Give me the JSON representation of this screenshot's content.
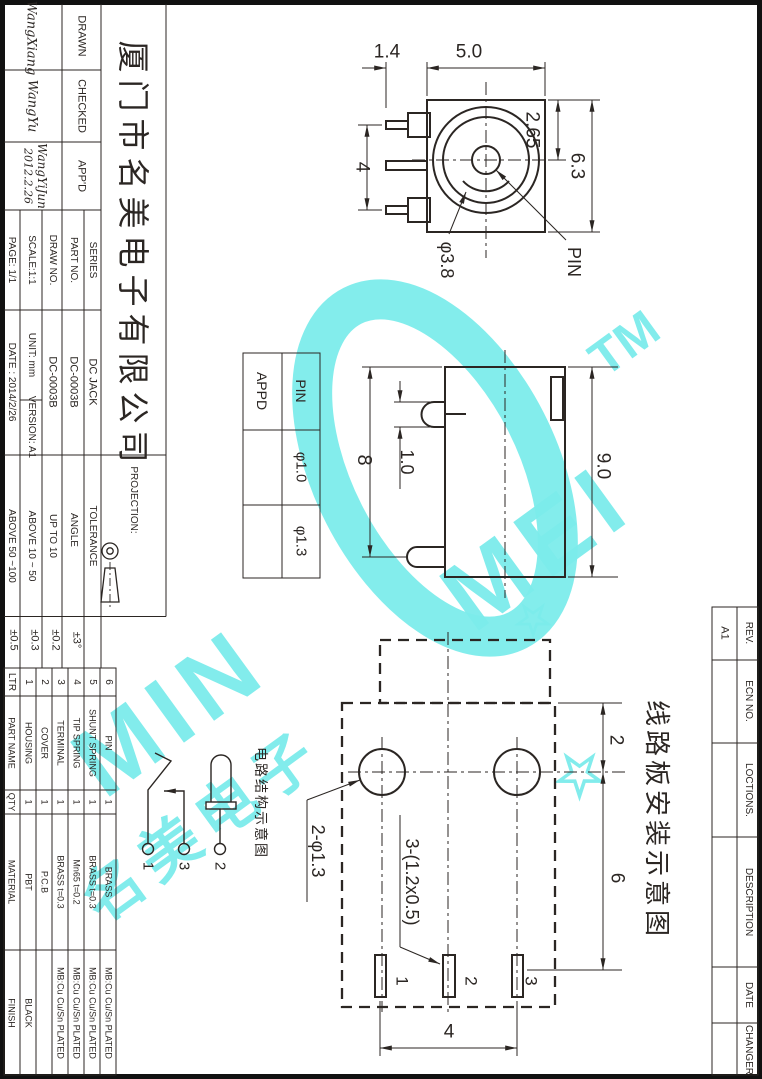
{
  "sheet": {
    "company": "厦门市名美电子有限公司",
    "signatures": {
      "drawn_label": "DRAWN",
      "checked_label": "CHECKED",
      "approved_label": "APP'D",
      "drawn": "WangXiang",
      "checked": "WangYu",
      "approved": "WangYiJun",
      "approved_date": "2012.2.26"
    },
    "fields": {
      "series_label": "SERIES",
      "series": "DC JACK",
      "part_no_label": "PART NO.",
      "part_no": "DC-0003B",
      "draw_no_label": "DRAW NO.",
      "draw_no": "DC-0003B",
      "scale": "SCALE:1:1",
      "unit": "UNIT: mm",
      "version": "VERSION: A1",
      "page": "PAGE: 1/1",
      "date": "DATE : 2014/2/26",
      "projection_label": "PROJECTION:"
    },
    "tolerance": {
      "header": "TOLERANCE",
      "rows": [
        {
          "label": "ANGLE",
          "value": "±3°"
        },
        {
          "label": "UP TO 10",
          "value": "±0.2"
        },
        {
          "label": "ABOVE 10 ~ 50",
          "value": "±0.3"
        },
        {
          "label": "ABOVE 50 ~100",
          "value": "±0.5"
        }
      ]
    },
    "bom": {
      "headers": {
        "ltr": "LTR",
        "part_name": "PART NAME",
        "qty": "QTY",
        "material": "MATERIAL",
        "finish": "FINISH"
      },
      "rows": [
        {
          "ltr": "1",
          "name": "HOUSING",
          "qty": "1",
          "material": "PBT",
          "finish": "BLACK"
        },
        {
          "ltr": "2",
          "name": "COVER",
          "qty": "1",
          "material": "P.C.B",
          "finish": ""
        },
        {
          "ltr": "3",
          "name": "TERMINAL",
          "qty": "1",
          "material": "BRASS t=0.3",
          "finish": "MB:Cu Cu/Sn PLATED"
        },
        {
          "ltr": "4",
          "name": "TIP SPRING",
          "qty": "1",
          "material": "Mn65 t=0.2",
          "finish": "MB:Cu Cu/Sn PLATED"
        },
        {
          "ltr": "5",
          "name": "SHUNT SPRING",
          "qty": "1",
          "material": "BRASS t=0.3",
          "finish": "MB:Cu Cu/Sn PLATED"
        },
        {
          "ltr": "6",
          "name": "PIN",
          "qty": "1",
          "material": "BRASS",
          "finish": "MB:Cu Cu/Sn PLATED"
        }
      ]
    },
    "revision": {
      "rev_label": "REV.",
      "rev_value": "A1",
      "ecn_label": "ECN NO.",
      "locations_label": "LOCTIONS.",
      "description_label": "DESCRIPTION",
      "date_label": "DATE",
      "changer_label": "CHANGER"
    }
  },
  "views": {
    "front": {
      "dims": {
        "pin_offset": "1.4",
        "body_width": "5.0",
        "center_from_top": "2.65",
        "body_height": "6.3",
        "pin_pitch": "4",
        "barrel_dia": "φ3.8",
        "pin_callout": "PIN"
      }
    },
    "side": {
      "table": {
        "appd": "APPD",
        "pin": "PIN",
        "dia_small": "φ1.0",
        "dia_large": "φ1.3"
      },
      "dims": {
        "body_height": "8",
        "pin_thickness": "1.0",
        "overall": "9.0"
      }
    },
    "pcb": {
      "title": "线路板安装示意图",
      "dims": {
        "hole_from_edge": "2",
        "hole_to_pad": "6",
        "pad_pitch": "4",
        "holes": "2-φ1.3",
        "slots": "3-(1.2x0.5)"
      },
      "pads": [
        "1",
        "2",
        "3"
      ]
    },
    "schematic": {
      "title": "电路结构示意图",
      "pins": [
        "1",
        "3",
        "2"
      ]
    }
  },
  "watermark": {
    "text_left": "MIN",
    "text_right": "MEI",
    "tm": "TM",
    "cjk": "名美电子",
    "star": "☆",
    "color": "#7CECEA"
  }
}
